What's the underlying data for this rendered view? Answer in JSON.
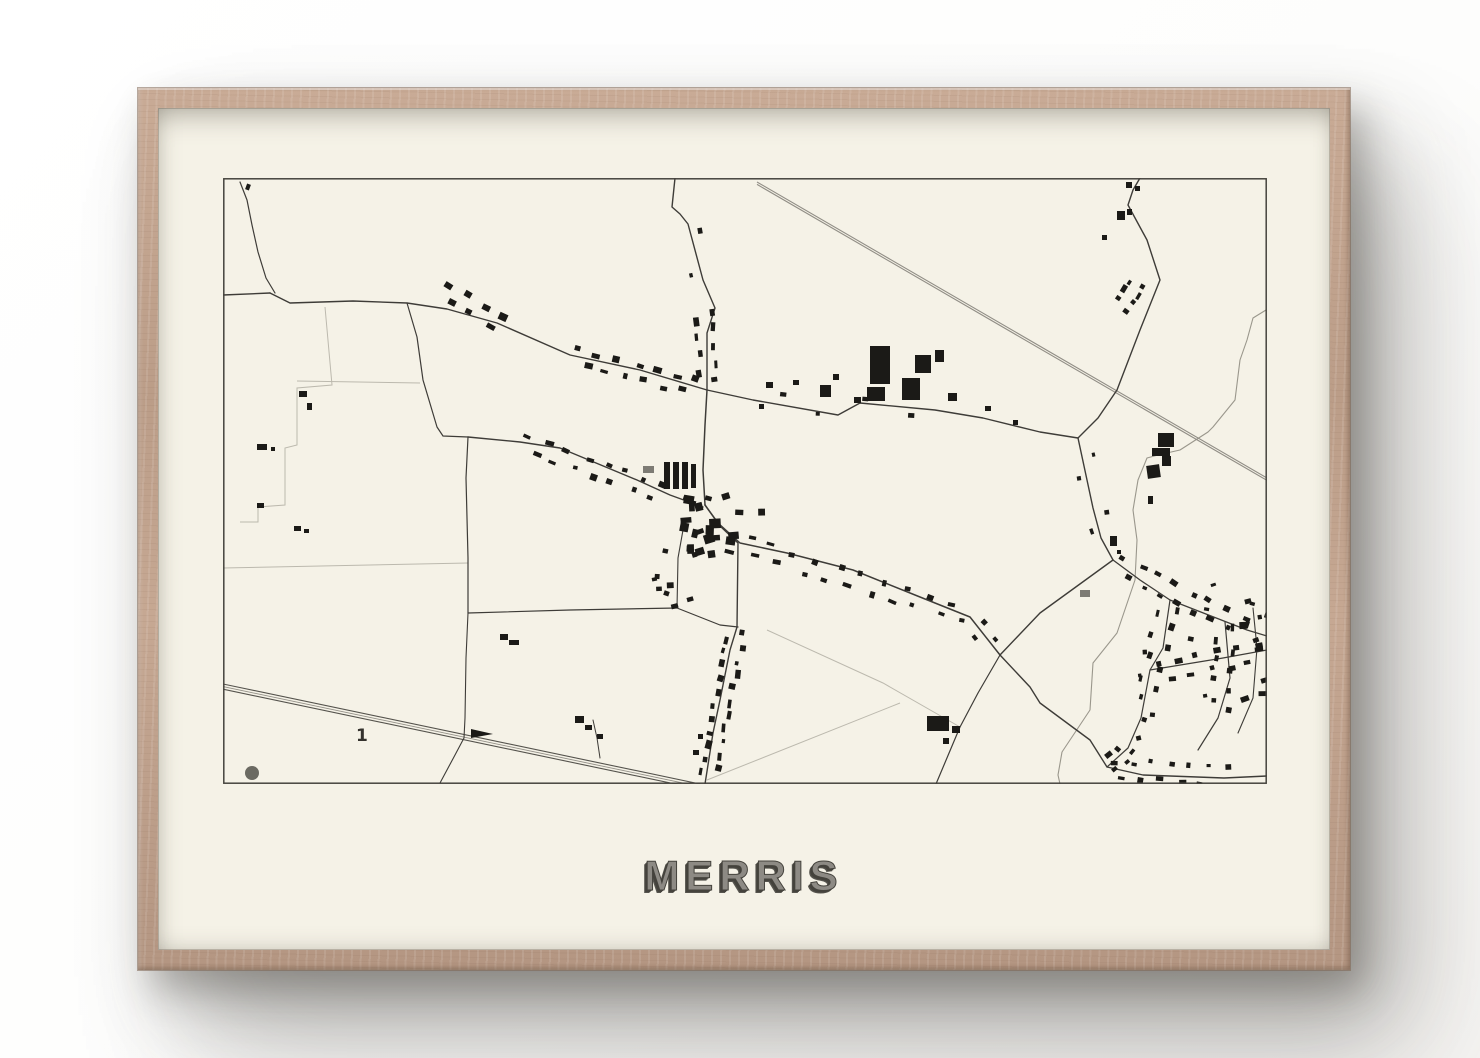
{
  "poster": {
    "title": "MERRIS"
  },
  "colors": {
    "wall": "#ffffff",
    "frame_wood": "#bf9f8a",
    "paper": "#f5f2e7",
    "ink": "#1b1a17",
    "gray_building": "#7d7b74",
    "road": "#3e3c38",
    "light_line": "#bcb9ae",
    "rail_dark": "#55534d",
    "rail_gray": "#918e86",
    "water": "#9a978c",
    "border": "#45433d",
    "dot": "#6b6a62",
    "title_fill": "#8d8a84",
    "title_shadow": "#45433d",
    "label_ink": "#34322d"
  },
  "map": {
    "width": 1044,
    "height": 606,
    "label": {
      "text": "1",
      "x": 133,
      "y": 563,
      "size": 17
    },
    "dot": {
      "cx": 29,
      "cy": 595,
      "r": 7
    },
    "wedge": "248,551 270,556 248,560",
    "roads": [
      {
        "d": "M452,0 L449,29 L457,36 L465,46 L480,102 L492,130 L484,155 L484,212",
        "w": 1.4
      },
      {
        "d": "M47,115 L67,125 L130,123 L184,125 L224,131 L274,145 L347,177 L417,192 L484,212",
        "w": 1.4
      },
      {
        "d": "M0,117 L47,115",
        "w": 1.4
      },
      {
        "d": "M17,4 L24,22 L29,47 L35,74 L43,100 L52,115",
        "w": 1.2
      },
      {
        "d": "M184,125 L194,159 L200,202 L214,249 L220,258 L245,259",
        "w": 1.2
      },
      {
        "d": "M245,259 L243,300 L245,380 L245,435",
        "w": 1.2
      },
      {
        "d": "M245,435 L243,480 L242,540 L241,560 L232,577 L217,605",
        "w": 1.1
      },
      {
        "d": "M245,259 L297,264 L337,270 L414,302 L447,317 L480,329",
        "w": 1.4
      },
      {
        "d": "M484,212 L482,247 L480,292 L482,327",
        "w": 1.5
      },
      {
        "d": "M484,212 L530,222 L615,237 L637,225 L712,232 L760,240 L817,254 L855,260",
        "w": 1.4
      },
      {
        "d": "M917,0 L910,12 L905,27 L924,62 L937,102 L917,152 L894,212 L875,240 L855,260",
        "w": 1.4
      },
      {
        "d": "M855,260 L870,330 L878,360 L890,382",
        "w": 1.4
      },
      {
        "d": "M777,477 L817,435 L890,382",
        "w": 1.4
      },
      {
        "d": "M482,327 L495,345 L517,365 L564,375 L630,392 L697,419 L747,439 L777,477",
        "w": 1.5
      },
      {
        "d": "M482,327 L497,348 L515,365 L514,449 L507,472 L497,522 L490,555 L482,606",
        "w": 1.4
      },
      {
        "d": "M245,435 L347,432 L454,430 L497,447 L515,449",
        "w": 1.2
      },
      {
        "d": "M460,352 L455,380 L454,430",
        "w": 1.1
      },
      {
        "d": "M777,477 L807,509 L817,525 L867,562 L884,589 L920,597 L1001,600 L1044,598",
        "w": 1.4
      },
      {
        "d": "M777,477 L755,515 L737,549 L713,606",
        "w": 1.2
      },
      {
        "d": "M890,382 L917,402 L947,422 L1024,452 L1044,458",
        "w": 1.3
      },
      {
        "d": "M947,422 L940,470 L927,492 L918,540 L905,570 L884,589",
        "w": 1.2
      },
      {
        "d": "M927,492 L1000,480 L1044,472",
        "w": 1.2
      },
      {
        "d": "M1002,444 L1007,500 L995,540 L975,572",
        "w": 1.2
      },
      {
        "d": "M1030,430 L1034,470 L1030,520 L1015,555",
        "w": 1.1
      },
      {
        "d": "M370,542 L374,560 L377,580",
        "w": 1.0
      }
    ],
    "light_lines": [
      {
        "d": "M74,203 L197,205"
      },
      {
        "d": "M102,129 L109,207 L74,210 L74,267 L62,270 L62,327 L35,329 L35,344 L17,344"
      },
      {
        "d": "M0,390 L245,385"
      },
      {
        "d": "M544,452 L660,505 L737,549"
      },
      {
        "d": "M677,525 L484,602"
      }
    ],
    "streams": [
      {
        "d": "M1043,132 L1030,140 L1024,162 L1017,182 L1012,222 L990,249 L985,254 L957,272 L935,277 L924,280 L915,302 L910,332 L914,362 L912,402 L894,455 L870,485 L867,532 L839,574 L835,597 L837,606"
      }
    ],
    "rails": {
      "sw": {
        "x1": 0,
        "y1": 506,
        "x2": 477,
        "y2": 606,
        "offsets": [
          0,
          2.6,
          5.2
        ]
      },
      "ne": {
        "x1": 534,
        "y1": 4,
        "x2": 1044,
        "y2": 300,
        "offsets": [
          0,
          2.4
        ]
      }
    },
    "clusters": [
      {
        "l": [
          217,
          112,
          284,
          147
        ],
        "n": 7,
        "o": 5,
        "s": [
          5,
          10
        ]
      },
      {
        "l": [
          350,
          178,
          478,
          210
        ],
        "n": 13,
        "o": 5,
        "s": [
          4,
          9
        ]
      },
      {
        "l": [
          481,
          130,
          484,
          206
        ],
        "n": 9,
        "o": 5,
        "s": [
          4,
          9
        ]
      },
      {
        "l": [
          466,
          50,
          479,
          100
        ],
        "n": 2,
        "o": 5,
        "s": [
          4,
          7
        ]
      },
      {
        "r": [
          452,
          312,
          88,
          62
        ],
        "n": 24,
        "s": [
          5,
          12
        ]
      },
      {
        "l": [
          299,
          265,
          445,
          316
        ],
        "n": 15,
        "o": 5,
        "s": [
          4,
          9
        ]
      },
      {
        "l": [
          520,
          367,
          745,
          438
        ],
        "n": 20,
        "o": 5,
        "s": [
          4,
          9
        ]
      },
      {
        "l": [
          514,
          452,
          484,
          600
        ],
        "n": 22,
        "o": 5,
        "s": [
          4,
          9
        ]
      },
      {
        "r": [
          428,
          360,
          42,
          70
        ],
        "n": 9,
        "s": [
          4,
          8
        ]
      },
      {
        "l": [
          532,
          223,
          700,
          232
        ],
        "n": 4,
        "o": 6,
        "s": [
          4,
          7
        ]
      },
      {
        "l": [
          916,
          103,
          897,
          130
        ],
        "n": 7,
        "o": 5,
        "s": [
          4,
          8
        ]
      },
      {
        "l": [
          893,
          385,
          1022,
          451
        ],
        "n": 15,
        "o": 6,
        "s": [
          4,
          8
        ]
      },
      {
        "l": [
          945,
          424,
          920,
          538
        ],
        "n": 11,
        "o": 6,
        "s": [
          4,
          8
        ]
      },
      {
        "l": [
          906,
          568,
          886,
          588
        ],
        "n": 5,
        "o": 5,
        "s": [
          4,
          8
        ]
      },
      {
        "l": [
          888,
          591,
          1008,
          600
        ],
        "n": 13,
        "o": 6,
        "s": [
          4,
          8
        ]
      },
      {
        "l": [
          929,
          494,
          1040,
          474
        ],
        "n": 11,
        "o": 6,
        "s": [
          4,
          8
        ]
      },
      {
        "l": [
          1003,
          446,
          996,
          538
        ],
        "n": 9,
        "o": 6,
        "s": [
          4,
          8
        ]
      },
      {
        "r": [
          1016,
          408,
          28,
          112
        ],
        "n": 12,
        "s": [
          4,
          9
        ]
      },
      {
        "r": [
          895,
          405,
          105,
          155
        ],
        "n": 8,
        "s": [
          3,
          6
        ]
      },
      {
        "l": [
          858,
          268,
          884,
          370
        ],
        "n": 4,
        "o": 6,
        "s": [
          4,
          7
        ]
      },
      {
        "l": [
          747,
          442,
          772,
          472
        ],
        "n": 3,
        "o": 6,
        "s": [
          4,
          7
        ]
      }
    ],
    "buildings": [
      [
        441,
        284,
        6,
        27,
        0
      ],
      [
        450,
        284,
        6,
        27,
        0
      ],
      [
        459,
        284,
        6,
        27,
        0
      ],
      [
        468,
        286,
        5,
        24,
        0
      ],
      [
        647,
        168,
        20,
        38,
        0
      ],
      [
        692,
        177,
        16,
        18,
        0
      ],
      [
        712,
        172,
        9,
        12,
        0
      ],
      [
        679,
        200,
        18,
        22,
        0
      ],
      [
        644,
        209,
        18,
        14,
        0
      ],
      [
        725,
        215,
        9,
        8,
        0
      ],
      [
        597,
        207,
        11,
        12,
        0
      ],
      [
        610,
        196,
        6,
        6,
        0
      ],
      [
        631,
        219,
        7,
        6,
        0
      ],
      [
        935,
        255,
        16,
        14,
        0
      ],
      [
        929,
        270,
        18,
        8,
        0
      ],
      [
        939,
        278,
        9,
        10,
        0
      ],
      [
        924,
        287,
        13,
        13,
        -8
      ],
      [
        925,
        318,
        5,
        8,
        0
      ],
      [
        887,
        358,
        7,
        10,
        0
      ],
      [
        894,
        372,
        4,
        4,
        0
      ],
      [
        903,
        4,
        6,
        6,
        0
      ],
      [
        912,
        8,
        5,
        5,
        0
      ],
      [
        894,
        33,
        8,
        9,
        0
      ],
      [
        904,
        31,
        5,
        6,
        0
      ],
      [
        879,
        57,
        5,
        5,
        0
      ],
      [
        704,
        538,
        22,
        15,
        0
      ],
      [
        729,
        548,
        8,
        7,
        0
      ],
      [
        720,
        560,
        6,
        6,
        0
      ],
      [
        352,
        538,
        9,
        7,
        0
      ],
      [
        362,
        547,
        7,
        5,
        0
      ],
      [
        374,
        556,
        6,
        5,
        0
      ],
      [
        277,
        456,
        8,
        6,
        0
      ],
      [
        286,
        462,
        10,
        5,
        0
      ],
      [
        76,
        213,
        8,
        6,
        0
      ],
      [
        84,
        225,
        5,
        7,
        0
      ],
      [
        34,
        266,
        10,
        6,
        0
      ],
      [
        48,
        269,
        4,
        4,
        0
      ],
      [
        34,
        325,
        7,
        5,
        0
      ],
      [
        71,
        348,
        7,
        5,
        0
      ],
      [
        81,
        351,
        5,
        4,
        0
      ],
      [
        23,
        6,
        4,
        6,
        20
      ],
      [
        543,
        204,
        7,
        6,
        0
      ],
      [
        570,
        202,
        6,
        5,
        0
      ],
      [
        536,
        226,
        5,
        5,
        0
      ],
      [
        762,
        228,
        6,
        5,
        0
      ],
      [
        790,
        242,
        5,
        5,
        0
      ],
      [
        470,
        572,
        6,
        5,
        0
      ],
      [
        475,
        556,
        5,
        5,
        0
      ]
    ],
    "gray_buildings": [
      [
        420,
        288,
        11,
        7,
        0
      ],
      [
        857,
        412,
        10,
        7,
        0
      ]
    ]
  }
}
